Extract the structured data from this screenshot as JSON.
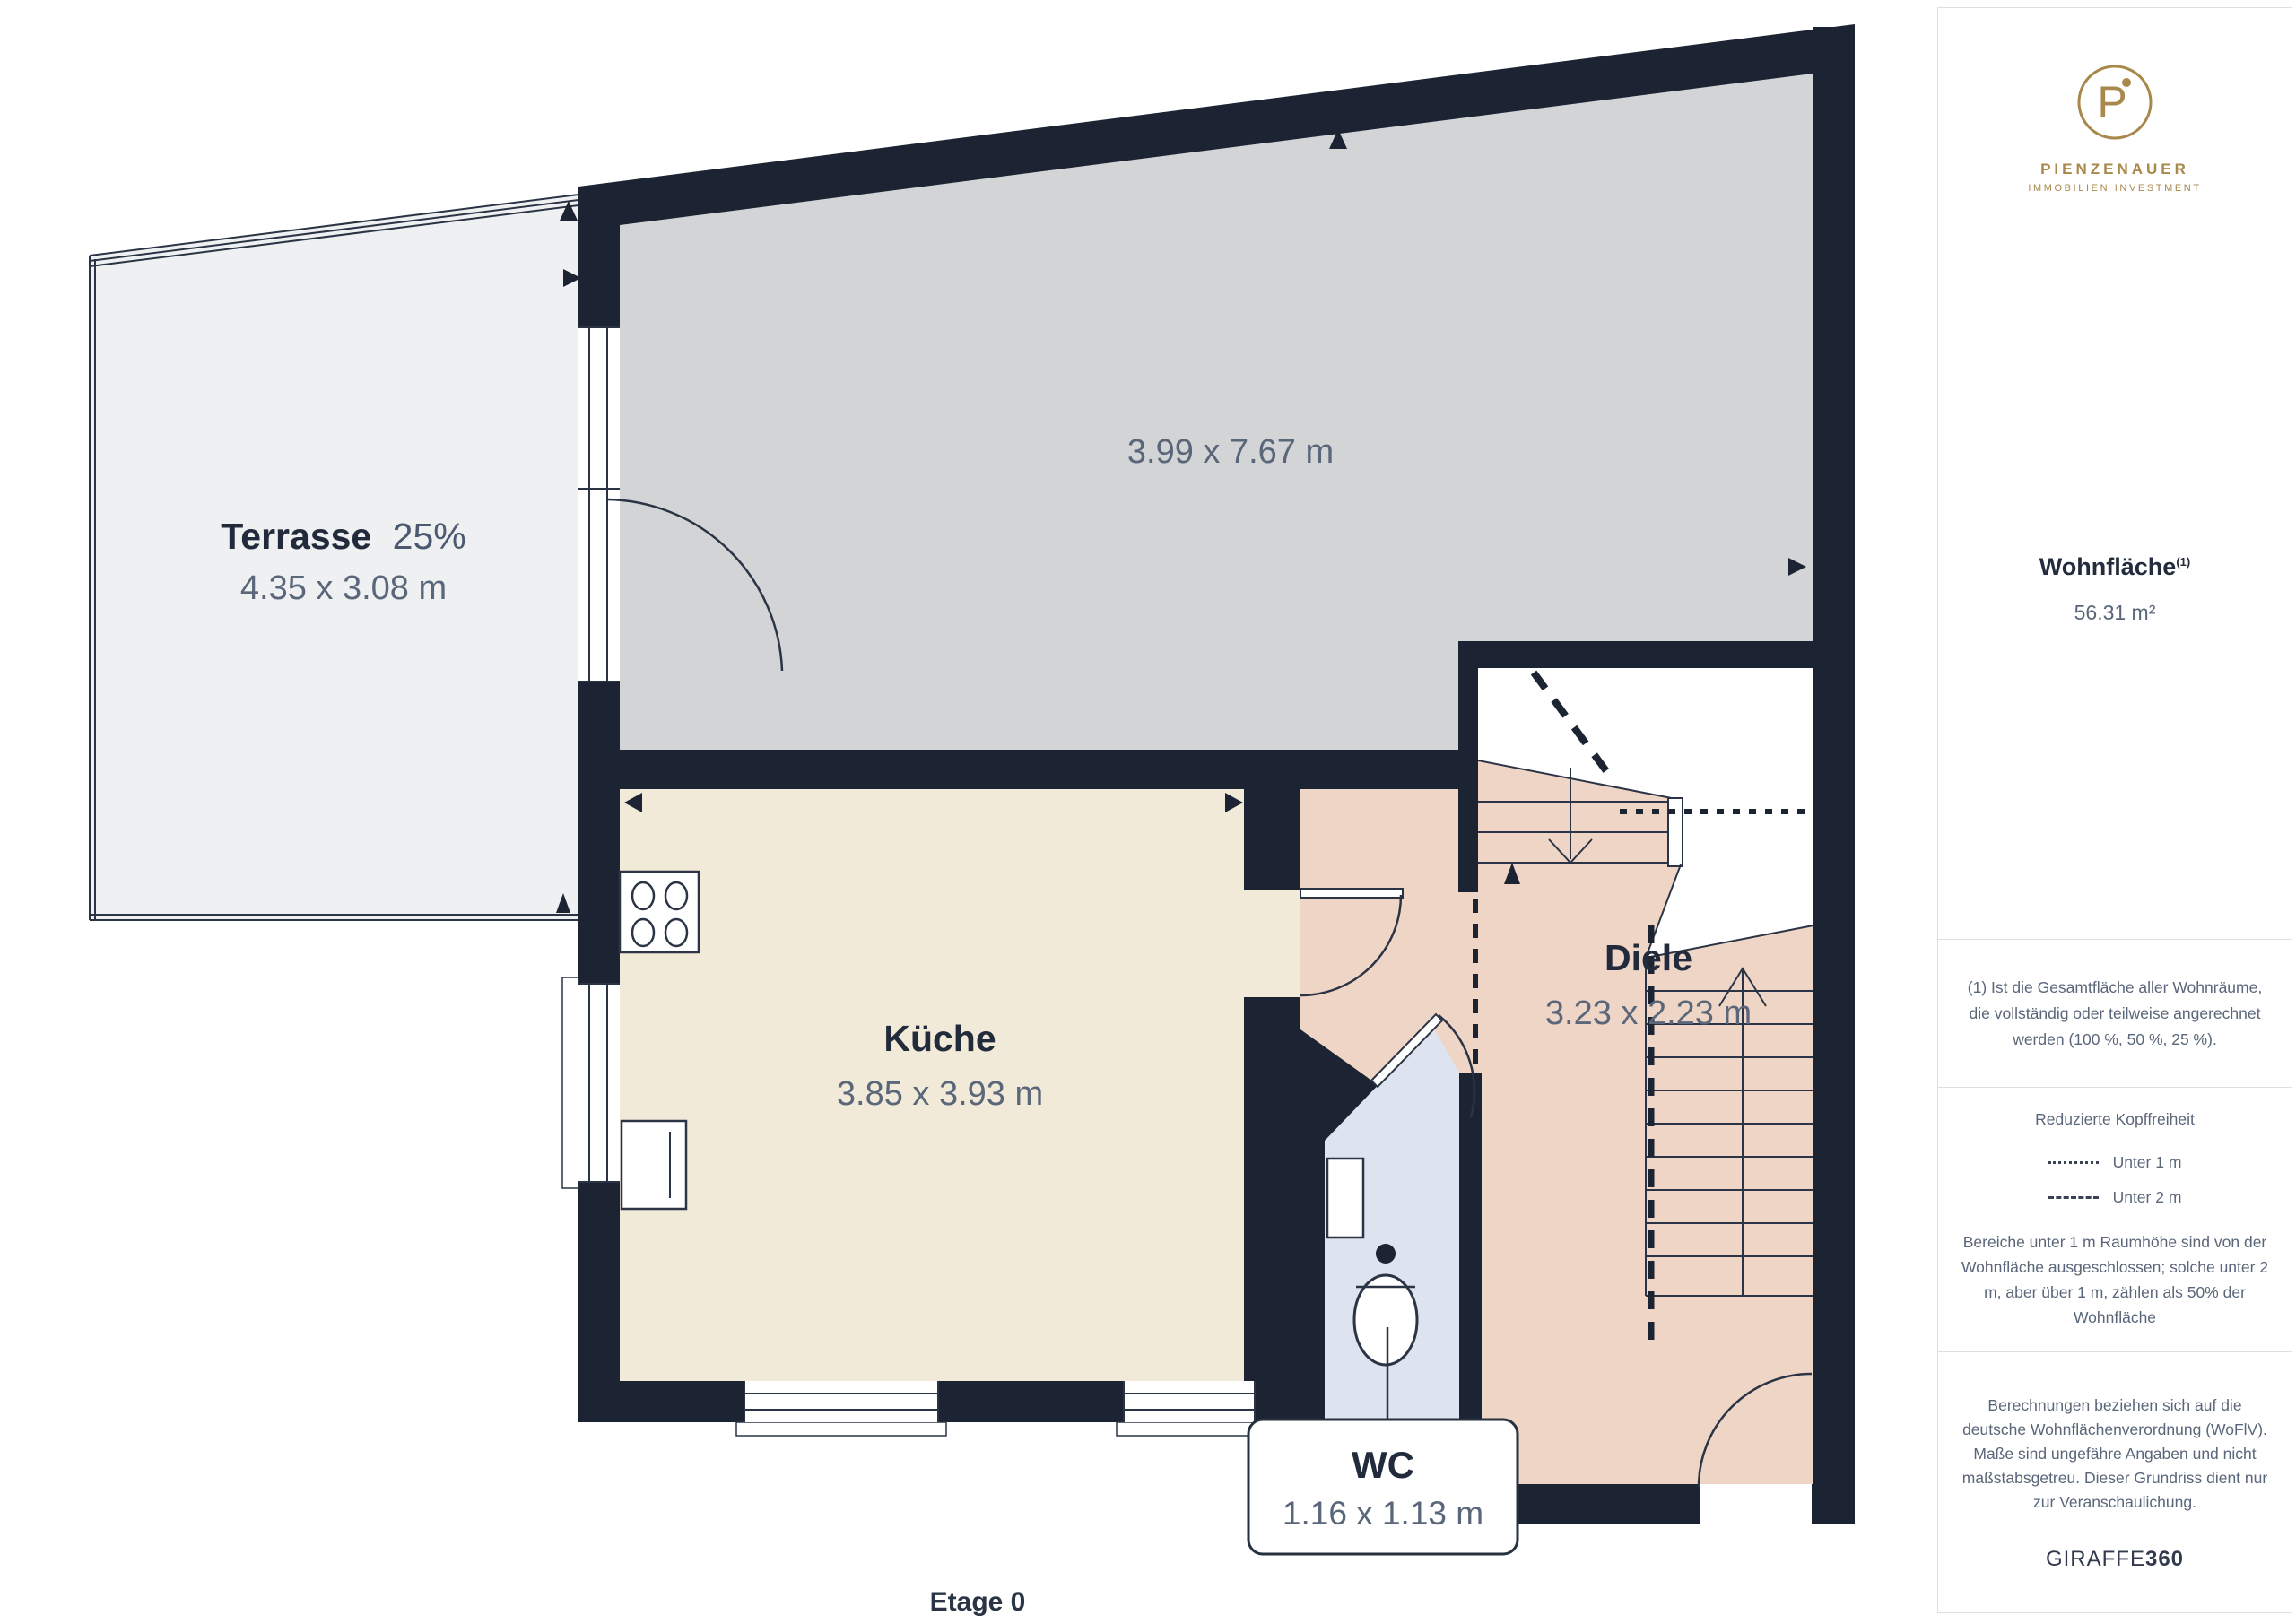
{
  "page": {
    "floor_label": "Etage 0"
  },
  "branding": {
    "monogram": "P",
    "name": "PIENZENAUER",
    "tagline": "IMMOBILIEN INVESTMENT",
    "gold": "#a8884b"
  },
  "sidebar": {
    "area_title": "Wohnfläche",
    "area_sup": "(1)",
    "area_value": "56.31 m²",
    "note_area": "(1) Ist die Gesamtfläche aller Wohnräume, die vollständig oder teilweise angerechnet werden (100 %, 50 %, 25 %).",
    "headroom": {
      "title": "Reduzierte Kopffreiheit",
      "legend": [
        {
          "style": "dotted",
          "label": "Unter 1 m"
        },
        {
          "style": "dashed",
          "label": "Unter 2 m"
        }
      ],
      "note": "Bereiche unter 1 m Raumhöhe sind von der Wohnfläche ausgeschlossen; solche unter 2 m, aber über 1 m, zählen als 50% der Wohnfläche"
    },
    "disclaimer": "Berechnungen beziehen sich auf die deutsche Wohnflächenverordnung (WoFlV). Maße sind ungefähre Angaben und nicht maßstabsgetreu. Dieser Grundriss dient nur zur Veranschaulichung.",
    "watermark": {
      "regular": "GIRAFFE",
      "bold": "360"
    }
  },
  "rooms": {
    "living": {
      "dims": "3.99 x 7.67 m"
    },
    "terrace": {
      "name": "Terrasse",
      "share": "25%",
      "dims": "4.35 x 3.08 m"
    },
    "kitchen": {
      "name": "Küche",
      "dims": "3.85 x 3.93 m"
    },
    "hall": {
      "name": "Diele",
      "dims": "3.23 x 2.23 m"
    },
    "wc": {
      "name": "WC",
      "dims": "1.16 x 1.13 m"
    }
  },
  "colors": {
    "wall": "#1c2433",
    "line": "#2a3445",
    "living_fill": "#d3d4d6",
    "kitchen_fill": "#f2ead8",
    "hall_fill": "#efd5c6",
    "wc_fill": "#dde3ef",
    "terrace_fill": "#eef0f2",
    "label_dark": "#222b3b",
    "label_muted": "#5a6679",
    "brand_gold": "#a8884b"
  }
}
